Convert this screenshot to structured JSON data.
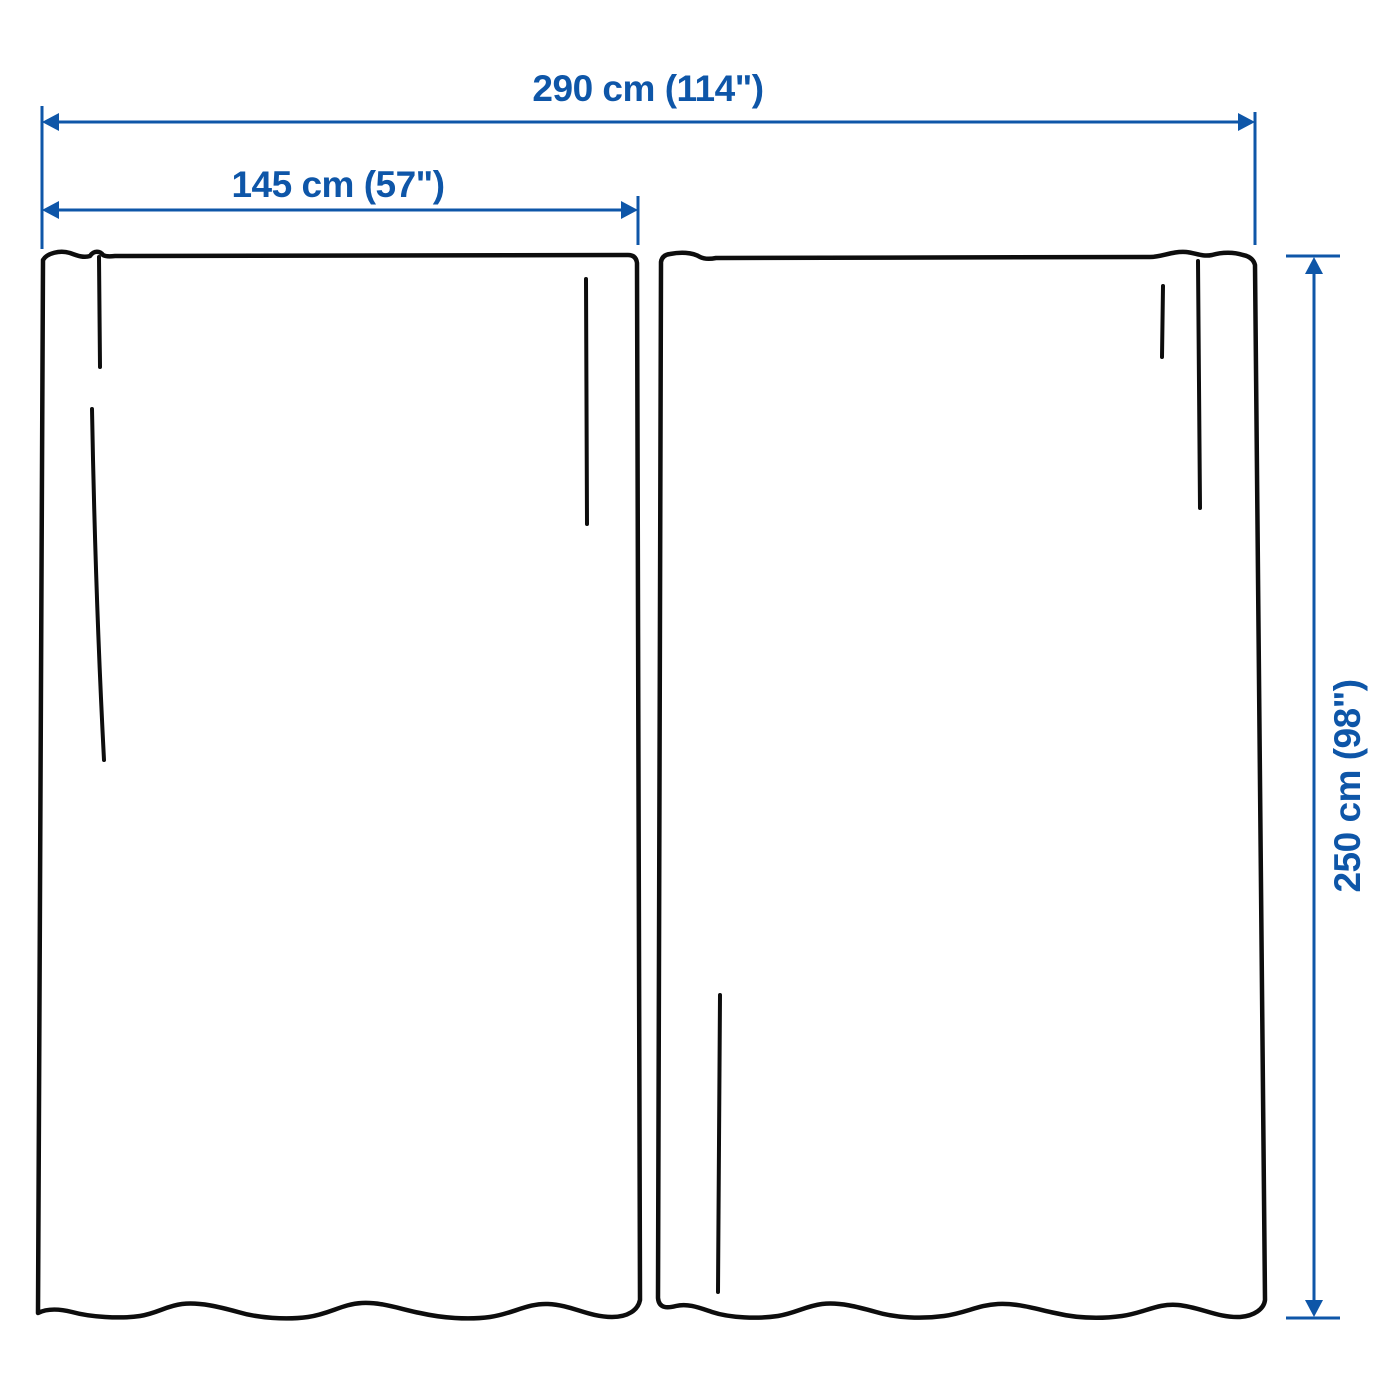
{
  "product": {
    "type_hint": "curtain-pair-measurement-diagram",
    "panel_count": 2
  },
  "dimensions": {
    "total_width_label": "290 cm (114\")",
    "panel_width_label": "145 cm (57\")",
    "height_label": "250 cm (98\")"
  },
  "colors": {
    "dimension_blue": "#0E56A8",
    "outline_black": "#0d0d0d",
    "background": "#ffffff"
  }
}
